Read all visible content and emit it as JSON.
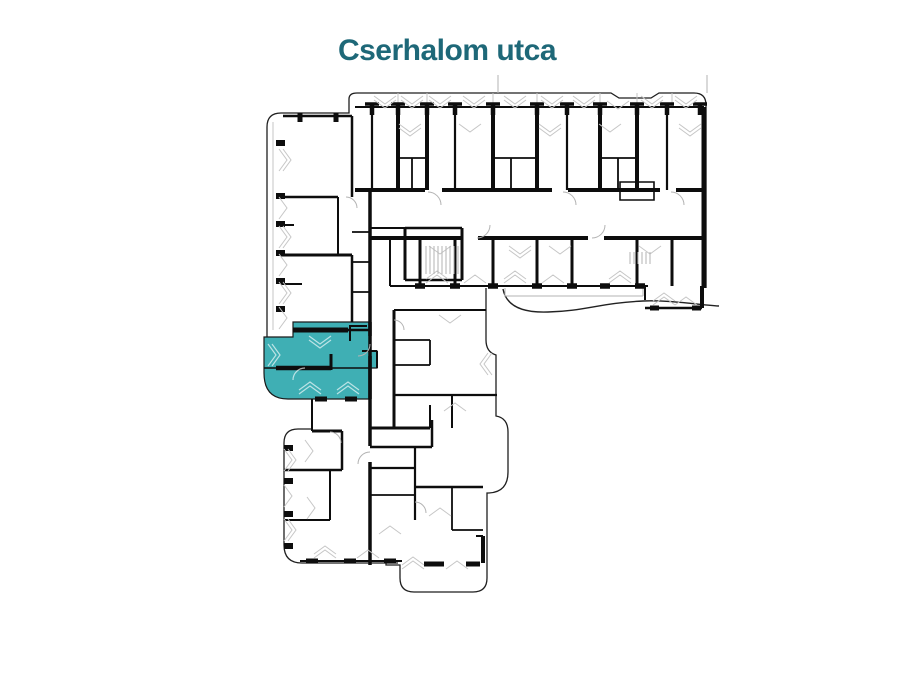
{
  "title": {
    "text": "Cserhalom utca",
    "color": "#1e6878"
  },
  "floorplan": {
    "highlight_color": "#3fafb4",
    "wall_color": "#0d0d0d",
    "outline_color": "#1f1f1f",
    "detail_color": "#c6c6c6",
    "background_color": "#ffffff",
    "highlighted_unit_label": "selected-apartment"
  }
}
